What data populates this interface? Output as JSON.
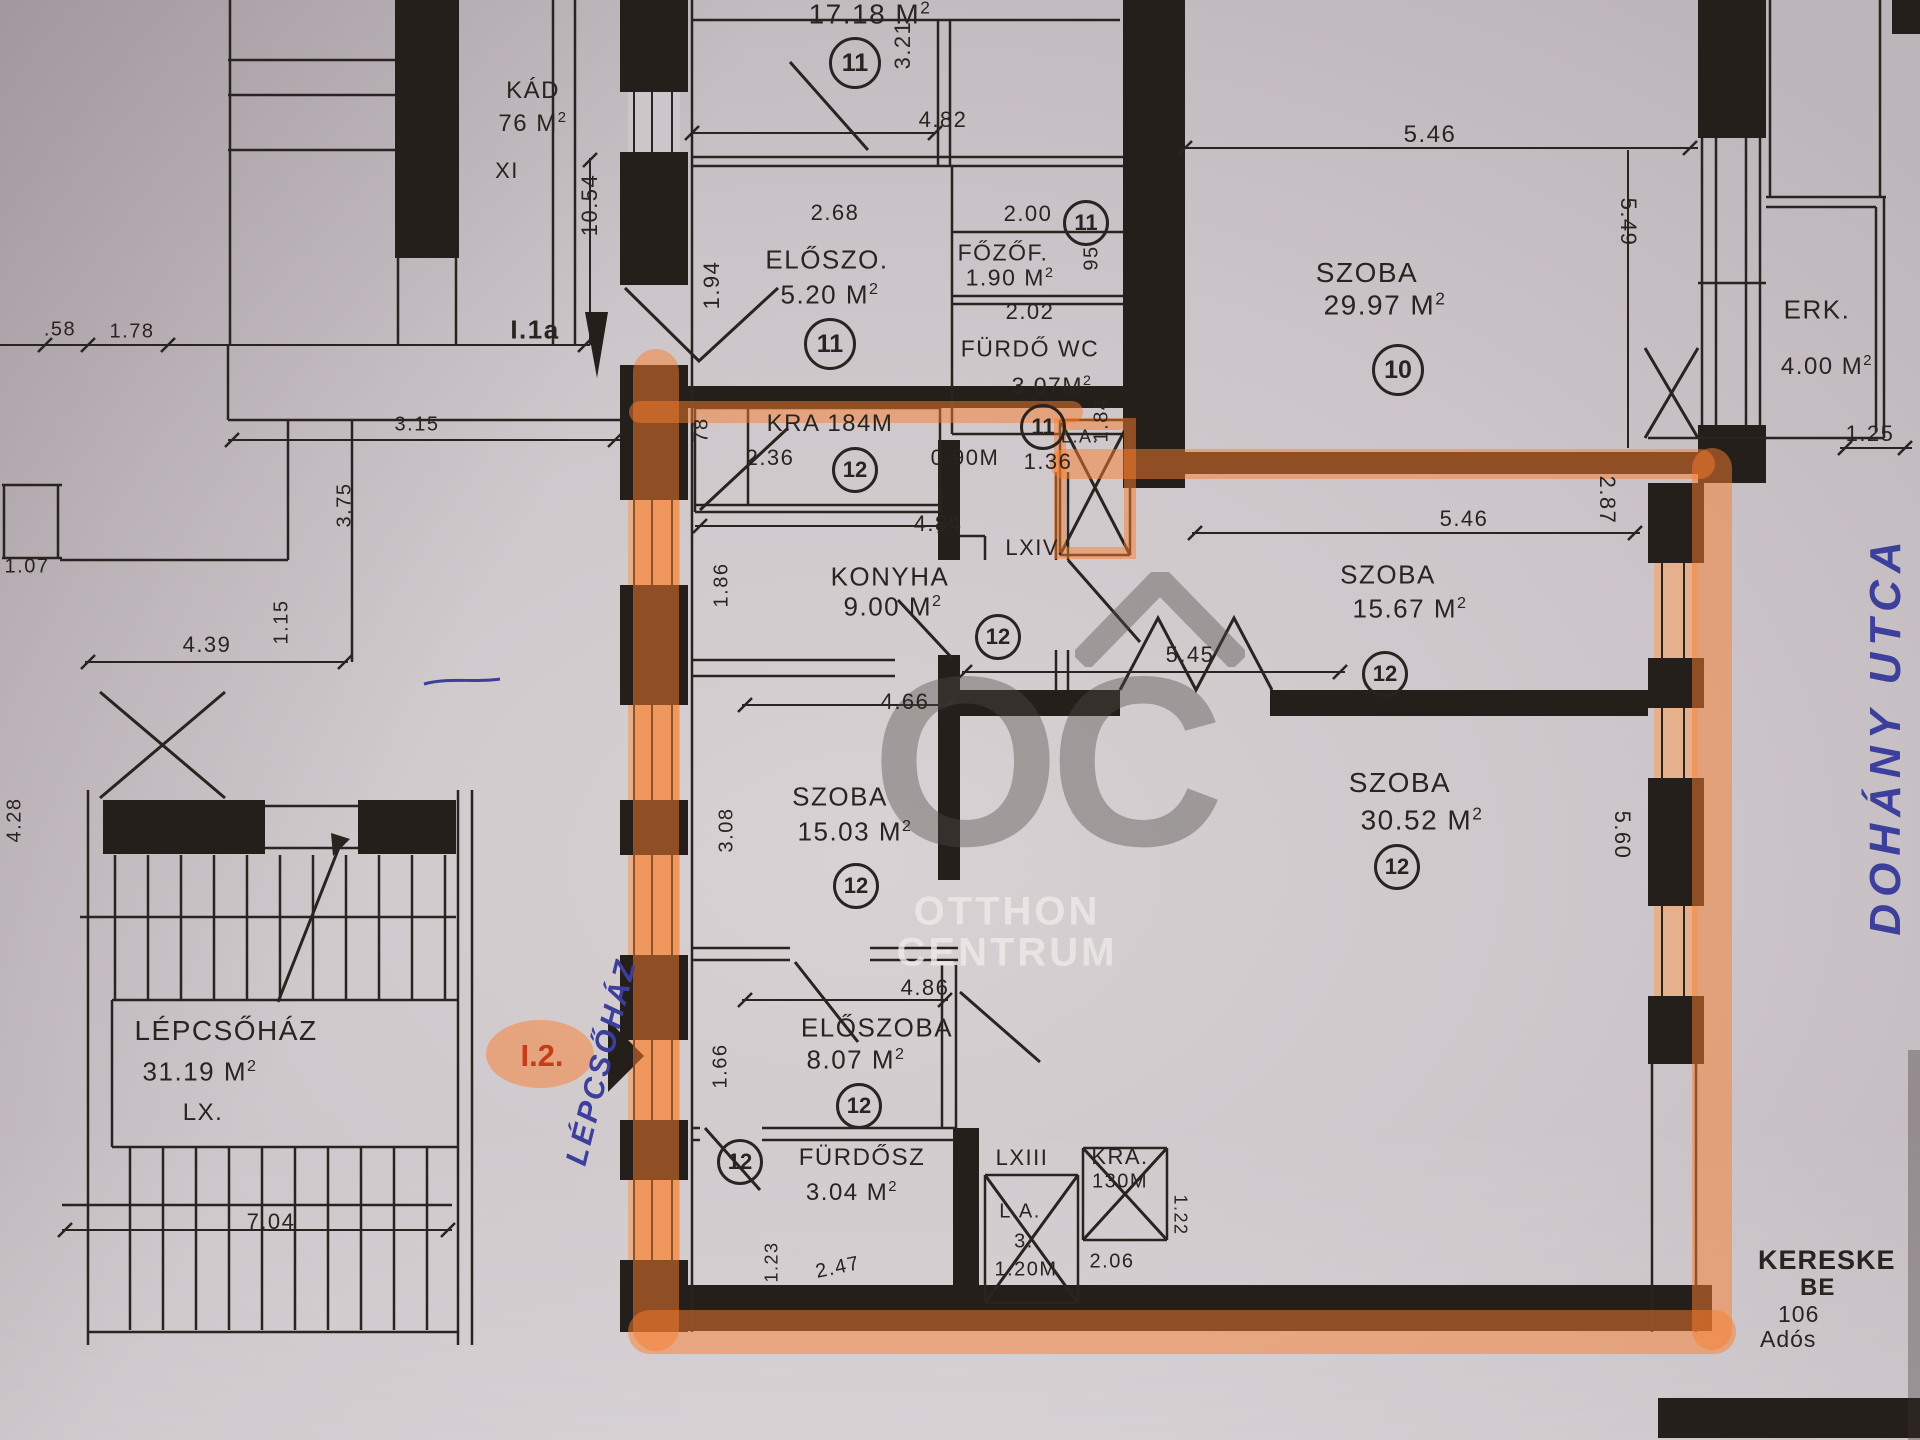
{
  "rooms": {
    "top": {
      "area": "17.18 M",
      "unit": "11"
    },
    "kad": {
      "name": "KÁD",
      "area": "76 M"
    },
    "xi": "XI",
    "eloszo": {
      "name": "ELŐSZO.",
      "area": "5.20 M",
      "unit": "11"
    },
    "fozof": {
      "name": "FŐZŐF.",
      "area": "1.90 M",
      "unit": "11"
    },
    "furdo": {
      "name": "FÜRDŐ WC",
      "area": "3.07M",
      "unit": "11"
    },
    "szoba_a": {
      "name": "SZOBA",
      "area": "29.97 M",
      "unit": "10"
    },
    "erk": {
      "name": "ERK.",
      "area": "4.00 M"
    },
    "kra": {
      "name": "KRA 184M",
      "unit": "12"
    },
    "la_top": "L.A.",
    "konyha": {
      "name": "KONYHA",
      "area": "9.00 M",
      "unit": "12"
    },
    "lxiv": "LXIV.",
    "szoba_b": {
      "name": "SZOBA",
      "area": "15.67 M",
      "unit": "12"
    },
    "szoba_c": {
      "name": "SZOBA",
      "area": "15.03 M",
      "unit": "12"
    },
    "szoba_d": {
      "name": "SZOBA",
      "area": "30.52 M",
      "unit": "12"
    },
    "eloszoba": {
      "name": "ELŐSZOBA",
      "area": "8.07 M",
      "unit": "12"
    },
    "furdosz": {
      "name": "FÜRDŐSZ",
      "area": "3.04 M",
      "unit": "12"
    },
    "lxiii": "LXIII",
    "lift": {
      "name": "L.A.",
      "num": "3.",
      "dim": "1.20M"
    },
    "kra_b": {
      "name": "KRA.",
      "dim": "130M"
    },
    "lepcsohaz": {
      "name": "LÉPCSŐHÁZ",
      "area": "31.19 M",
      "floor": "LX."
    }
  },
  "sup": "2",
  "dims": {
    "k1054": "10.54",
    "k321": "3.21",
    "k482": "4.82",
    "k268": "2.68",
    "k194": "1.94",
    "k200": "2.00",
    "k95": "95",
    "k202": "2.02",
    "k184": "1.84",
    "k546a": "5.46",
    "k549": "5.49",
    "k125": "1.25",
    "k78": "78",
    "k236": "2.36",
    "k090": "0.90M",
    "k136": "1.36",
    "k58": ".58",
    "k178": "1.78",
    "k315": "3.15",
    "k484": "4.84",
    "k186": "1.86",
    "k546b": "5.46",
    "k287": "2.87",
    "k466": "4.66",
    "k308": "3.08",
    "k545": "5.45",
    "k560": "5.60",
    "k439": "4.39",
    "k115": "1.15",
    "k375": "3.75",
    "k107": "1.07",
    "k428": "4.28",
    "k486": "4.86",
    "k166": "1.66",
    "k704": "7.04",
    "k123": "1.23",
    "k247": "2.47",
    "k206": "2.06",
    "k122": "1.22"
  },
  "markers": {
    "i1a": "I.1a",
    "i2": "I.2."
  },
  "handwriting": {
    "street": "DOHÁNY UTCA",
    "staircase": "LÉPCSŐHÁZ"
  },
  "watermark": {
    "logo": "OC",
    "line1": "OTTHON",
    "line2": "CENTRUM"
  },
  "corner_text": {
    "l1": "KERESKE",
    "l2": "BE",
    "l3": "106",
    "l4": "Adós"
  },
  "colors": {
    "highlight": "#f97e2e",
    "ink": "#29241f",
    "pen": "#3c3f9b",
    "marker_red": "#c63c1a",
    "paper": "#ccc5c9"
  }
}
